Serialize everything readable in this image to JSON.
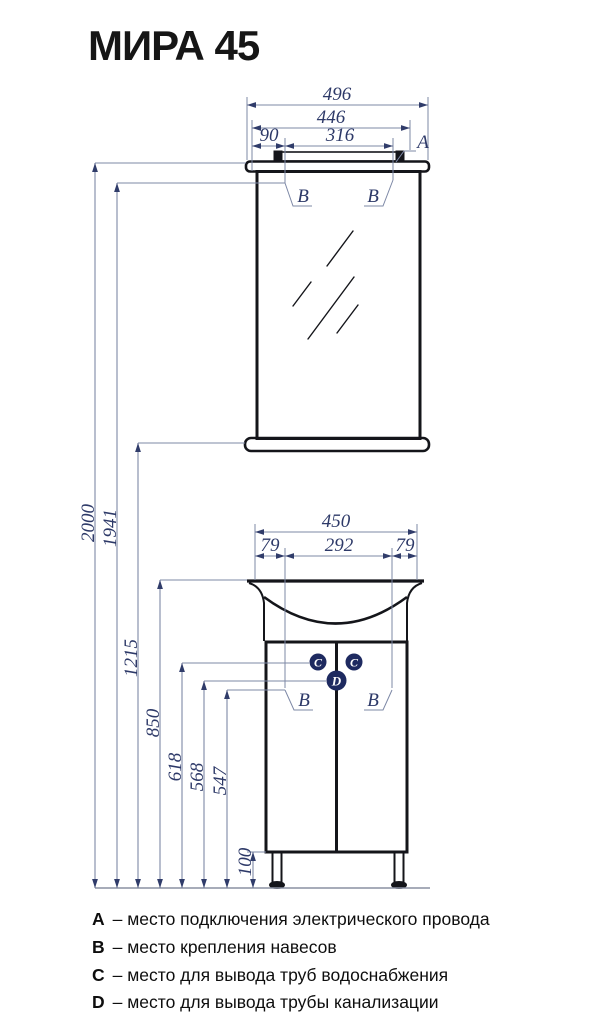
{
  "title": "МИРА 45",
  "mirror_dims": {
    "total_width": "496",
    "body_width": "446",
    "lamp_offset": "90",
    "lamp_width": "316"
  },
  "vanity_dims": {
    "total_width": "450",
    "left_offset": "79",
    "center_span": "292",
    "right_offset": "79"
  },
  "heights": {
    "total": "2000",
    "mirror_mount": "1941",
    "shelf": "1215",
    "basin_top": "850",
    "water_supply": "618",
    "drain": "568",
    "vanity_mount": "547",
    "leg": "100"
  },
  "markers": {
    "a": "A",
    "b": "B",
    "c": "C",
    "d": "D"
  },
  "legend": [
    {
      "key": "A",
      "text": "– место подключения электрического провода"
    },
    {
      "key": "B",
      "text": "– место крепления навесов"
    },
    {
      "key": "C",
      "text": "– место для вывода труб водоснабжения"
    },
    {
      "key": "D",
      "text": "– место для вывода трубы канализации"
    }
  ],
  "colors": {
    "marker_fill": "#1e2a60",
    "dimension_text": "#2d3968",
    "dimension_line": "#7d88a6",
    "drawing_line": "#14151a"
  }
}
